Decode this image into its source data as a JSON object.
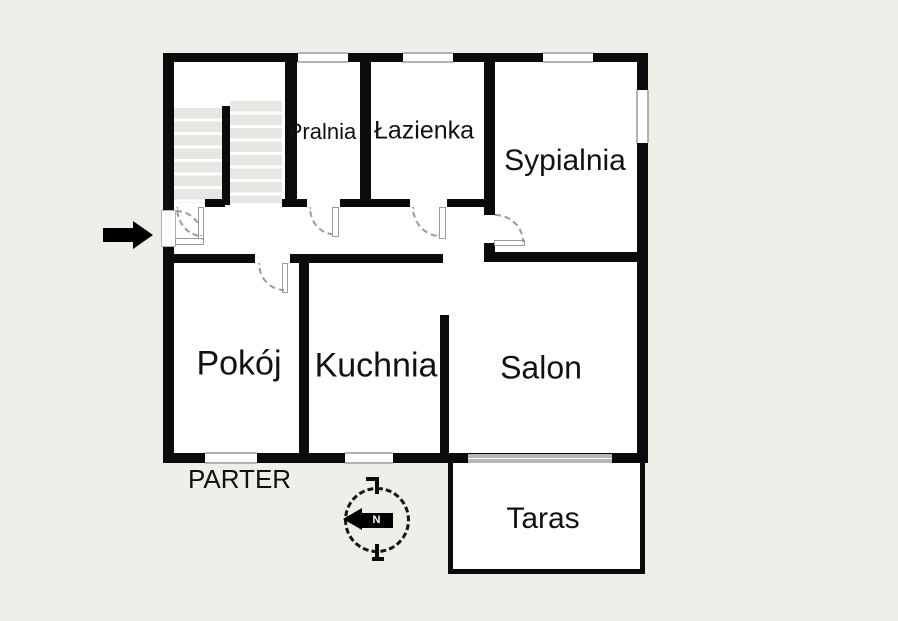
{
  "floor": {
    "label": "PARTER"
  },
  "rooms": {
    "pralnia": {
      "label": "Pralnia"
    },
    "lazienka": {
      "label": "Łazienka"
    },
    "sypialnia": {
      "label": "Sypialnia"
    },
    "pokoj": {
      "label": "Pokój"
    },
    "kuchnia": {
      "label": "Kuchnia"
    },
    "salon": {
      "label": "Salon"
    },
    "taras": {
      "label": "Taras"
    }
  },
  "icons": {
    "entrance": "entrance-arrow-icon",
    "compass": "compass-north-icon",
    "compass_letter": "N"
  },
  "colors": {
    "background": "#f0eee9",
    "wall": "#0b0b0b",
    "room_fill": "#ffffff",
    "window_gray": "#b2b2b2",
    "stair_tread": "#e7e6e3",
    "door_arc": "#9b9b9b"
  }
}
